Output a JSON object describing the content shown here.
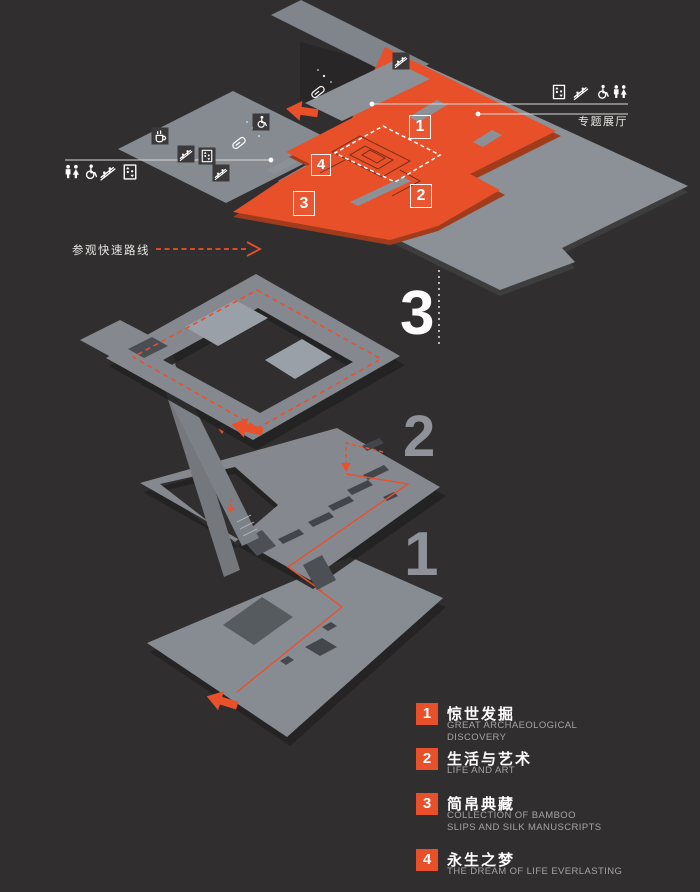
{
  "colors": {
    "background": "#312e2f",
    "accent_orange": "#e8502a",
    "floor_gray": "#8c9197",
    "dark_slot": "#42464b",
    "muted_number_gray": "#8f9399",
    "legend_text_gray": "#a5a3a2"
  },
  "plan": {
    "special_hall_label": "专题展厅",
    "route_legend_label": "参观快速路线",
    "zone_markers": [
      "1",
      "2",
      "3",
      "4"
    ]
  },
  "floors": {
    "third": "3",
    "second": "2",
    "first": "1"
  },
  "facility_icons": {
    "left_group": [
      "restroom",
      "wheelchair-access",
      "escalator",
      "elevator"
    ],
    "right_group": [
      "elevator",
      "escalator",
      "wheelchair-access",
      "restroom"
    ],
    "plan_icons": [
      "cafe",
      "escalator",
      "elevator",
      "escalator",
      "audio-guide",
      "wheelchair-lift",
      "audio-guide",
      "escalator"
    ]
  },
  "legend": {
    "items": [
      {
        "num": "1",
        "zh": "惊世发掘",
        "en": "GREAT ARCHAEOLOGICAL DISCOVERY"
      },
      {
        "num": "2",
        "zh": "生活与艺术",
        "en": "LIFE AND ART"
      },
      {
        "num": "3",
        "zh": "简帛典藏",
        "en": "COLLECTION OF BAMBOO SLIPS AND SILK MANUSCRIPTS"
      },
      {
        "num": "4",
        "zh": "永生之梦",
        "en": "THE DREAM OF LIFE EVERLASTING"
      }
    ]
  }
}
